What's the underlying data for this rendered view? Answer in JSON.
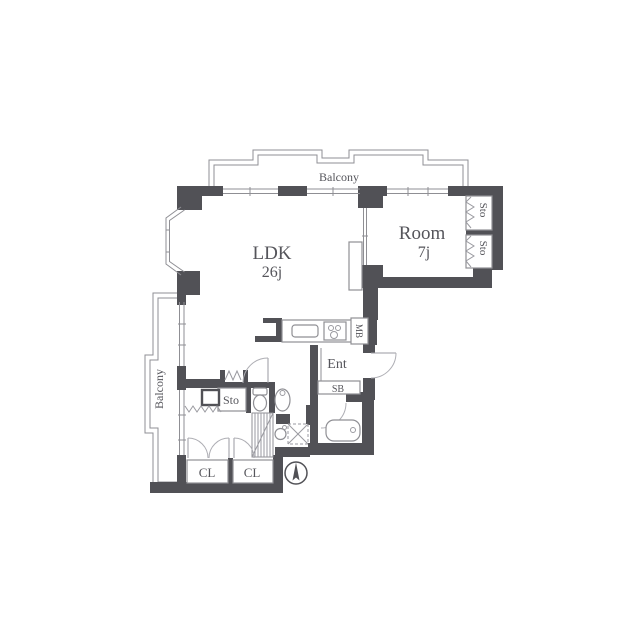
{
  "floorplan": {
    "labels": {
      "balcony_top": "Balcony",
      "balcony_left": "Balcony",
      "ldk": "LDK",
      "ldk_size": "26j",
      "room": "Room",
      "room_size": "7j",
      "sto_right_top": "Sto",
      "sto_right_bottom": "Sto",
      "meter_box": "MB",
      "entrance": "Ent",
      "shoe_box": "SB",
      "storage_mid": "Sto",
      "closet_left": "CL",
      "closet_right": "CL"
    },
    "icons": {
      "compass": "north-arrow-icon"
    },
    "colors": {
      "wall": "#515156",
      "outline": "#8f8f94",
      "text": "#55555b",
      "background": "#ffffff"
    }
  }
}
